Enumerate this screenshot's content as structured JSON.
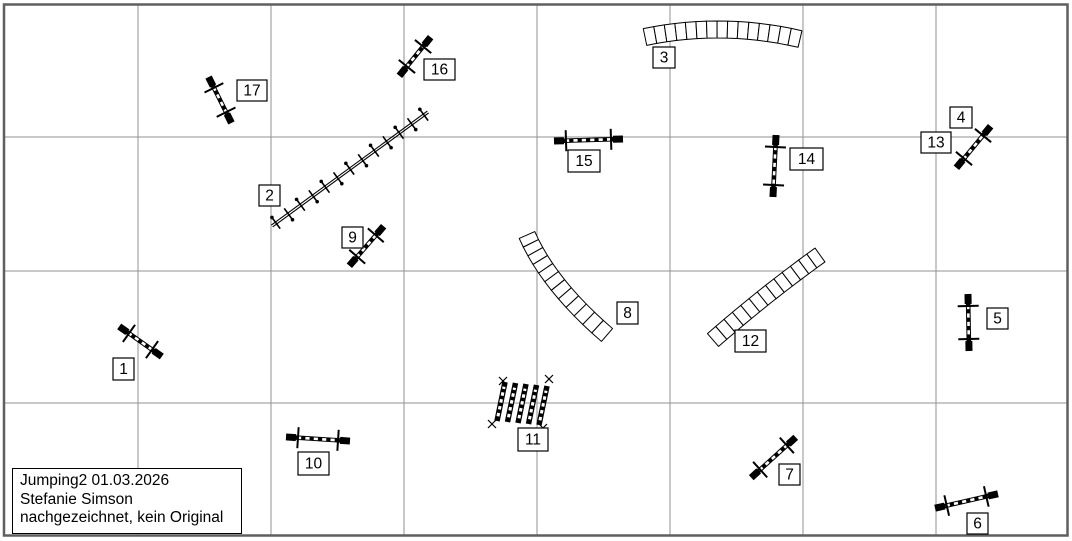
{
  "title_box": {
    "lines": [
      "Jumping2 01.03.2026",
      "Stefanie Simson",
      "nachgezeichnet, kein Original"
    ]
  },
  "canvas": {
    "width": 1072,
    "height": 541,
    "background": "#ffffff",
    "grid_color": "#929292",
    "border_color": "#5f5f5f",
    "obstacle_color": "#000000",
    "v_lines": [
      138,
      271,
      404,
      537,
      670,
      803,
      936
    ],
    "h_lines": [
      137,
      271,
      403
    ]
  },
  "obstacles": [
    {
      "type": "jump",
      "x1": 120,
      "y1": 327,
      "x2": 161,
      "y2": 356,
      "labels": [
        {
          "text": "1",
          "x": 113,
          "y": 358,
          "w": 21,
          "h": 22
        }
      ]
    },
    {
      "type": "weave",
      "x1": 272,
      "y1": 226,
      "x2": 428,
      "y2": 112,
      "poles": 13,
      "labels": [
        {
          "text": "2",
          "x": 259,
          "y": 185,
          "w": 21,
          "h": 21
        }
      ]
    },
    {
      "type": "tunnel",
      "p0": [
        645,
        37
      ],
      "c": [
        722,
        21
      ],
      "p1": [
        800,
        39
      ],
      "width": 17,
      "segments": 15,
      "labels": [
        {
          "text": "3",
          "x": 653,
          "y": 47,
          "w": 22,
          "h": 21
        }
      ]
    },
    {
      "type": "jump",
      "x1": 957,
      "y1": 167,
      "x2": 990,
      "y2": 127,
      "labels": [
        {
          "text": "4",
          "x": 950,
          "y": 107,
          "w": 22,
          "h": 21
        },
        {
          "text": "13",
          "x": 921,
          "y": 132,
          "w": 30,
          "h": 21
        }
      ]
    },
    {
      "type": "jump",
      "x1": 968,
      "y1": 295,
      "x2": 969,
      "y2": 350,
      "labels": [
        {
          "text": "5",
          "x": 987,
          "y": 308,
          "w": 21,
          "h": 21
        }
      ]
    },
    {
      "type": "jump",
      "x1": 936,
      "y1": 508,
      "x2": 997,
      "y2": 494,
      "labels": [
        {
          "text": "6",
          "x": 967,
          "y": 513,
          "w": 21,
          "h": 21
        }
      ]
    },
    {
      "type": "jump",
      "x1": 752,
      "y1": 477,
      "x2": 795,
      "y2": 438,
      "labels": [
        {
          "text": "7",
          "x": 779,
          "y": 464,
          "w": 21,
          "h": 21
        }
      ]
    },
    {
      "type": "tunnel",
      "p0": [
        527,
        235
      ],
      "c": [
        549,
        285
      ],
      "p1": [
        607,
        335
      ],
      "width": 17,
      "segments": 12,
      "labels": [
        {
          "text": "8",
          "x": 617,
          "y": 302,
          "w": 21,
          "h": 22
        }
      ]
    },
    {
      "type": "jump",
      "x1": 350,
      "y1": 265,
      "x2": 383,
      "y2": 227,
      "labels": [
        {
          "text": "9",
          "x": 342,
          "y": 227,
          "w": 21,
          "h": 21
        }
      ]
    },
    {
      "type": "jump",
      "x1": 287,
      "y1": 437,
      "x2": 349,
      "y2": 441,
      "labels": [
        {
          "text": "10",
          "x": 298,
          "y": 452,
          "w": 31,
          "h": 23
        }
      ]
    },
    {
      "type": "longjump",
      "bottom": [
        497,
        421
      ],
      "bar_vec": [
        8,
        -39
      ],
      "step": [
        10.5,
        1
      ],
      "bars": 5,
      "corner_marks": [
        [
          503,
          381
        ],
        [
          549,
          379
        ],
        [
          492,
          424
        ],
        [
          543,
          428
        ]
      ],
      "labels": [
        {
          "text": "11",
          "x": 518,
          "y": 428,
          "w": 30,
          "h": 23
        }
      ]
    },
    {
      "type": "tunnel",
      "p0": [
        713,
        340
      ],
      "c": [
        767,
        293
      ],
      "p1": [
        820,
        255
      ],
      "width": 17,
      "segments": 13,
      "labels": [
        {
          "text": "12",
          "x": 735,
          "y": 330,
          "w": 31,
          "h": 22
        }
      ]
    },
    {
      "type": "jump",
      "x1": 776,
      "y1": 136,
      "x2": 773,
      "y2": 196,
      "labels": [
        {
          "text": "14",
          "x": 790,
          "y": 148,
          "w": 33,
          "h": 22
        }
      ]
    },
    {
      "type": "jump",
      "x1": 555,
      "y1": 141,
      "x2": 622,
      "y2": 139,
      "labels": [
        {
          "text": "15",
          "x": 568,
          "y": 150,
          "w": 32,
          "h": 22
        }
      ]
    },
    {
      "type": "jump",
      "x1": 400,
      "y1": 75,
      "x2": 430,
      "y2": 38,
      "labels": [
        {
          "text": "16",
          "x": 424,
          "y": 59,
          "w": 31,
          "h": 21
        }
      ]
    },
    {
      "type": "jump",
      "x1": 209,
      "y1": 78,
      "x2": 231,
      "y2": 122,
      "labels": [
        {
          "text": "17",
          "x": 237,
          "y": 80,
          "w": 30,
          "h": 21
        }
      ]
    }
  ]
}
